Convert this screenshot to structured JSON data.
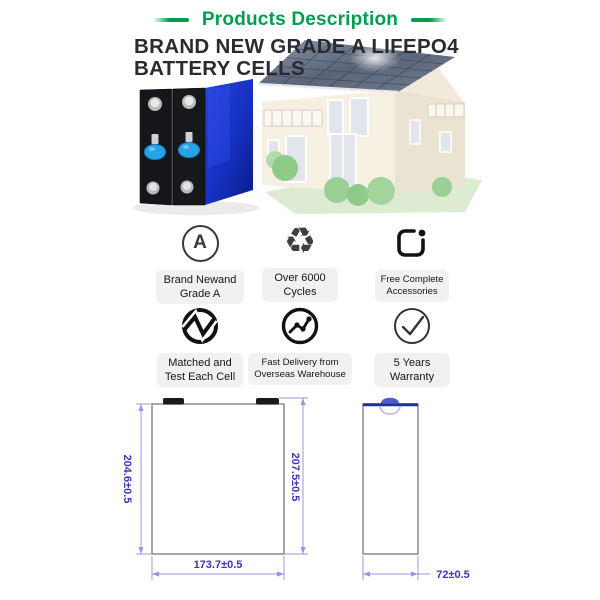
{
  "header": {
    "title": "Products Description",
    "accent_color": "#009E4D"
  },
  "headline": {
    "line1": "BRAND NEW GRADE A LIFEPO4",
    "line2": "BATTERY CELLS",
    "color": "#2a2a33"
  },
  "features": [
    {
      "icon": "grade-a-icon",
      "icon_glyph": "A",
      "lines": [
        "Brand Newand",
        "Grade A"
      ]
    },
    {
      "icon": "recycle-icon",
      "icon_glyph": "♻",
      "lines": [
        "Over 6000",
        "Cycles"
      ]
    },
    {
      "icon": "accessories-box-icon",
      "lines": [
        "Free Complete",
        "Accessories"
      ]
    },
    {
      "icon": "matched-pulse-icon",
      "lines": [
        "Matched and",
        "Test Each Cell"
      ]
    },
    {
      "icon": "delivery-chart-icon",
      "lines": [
        "Fast Delivery from",
        "Overseas Warehouse"
      ]
    },
    {
      "icon": "check-circle-icon",
      "lines": [
        "5 Years",
        "Warranty"
      ]
    }
  ],
  "drawing": {
    "front_height": "204.6±0.5",
    "total_height": "207.5±0.5",
    "width": "173.7±0.5",
    "depth": "72±0.5",
    "dim_text_color": "#3b35b5",
    "dim_line_color": "#9598e2",
    "outline_color": "#7a7a7a"
  }
}
